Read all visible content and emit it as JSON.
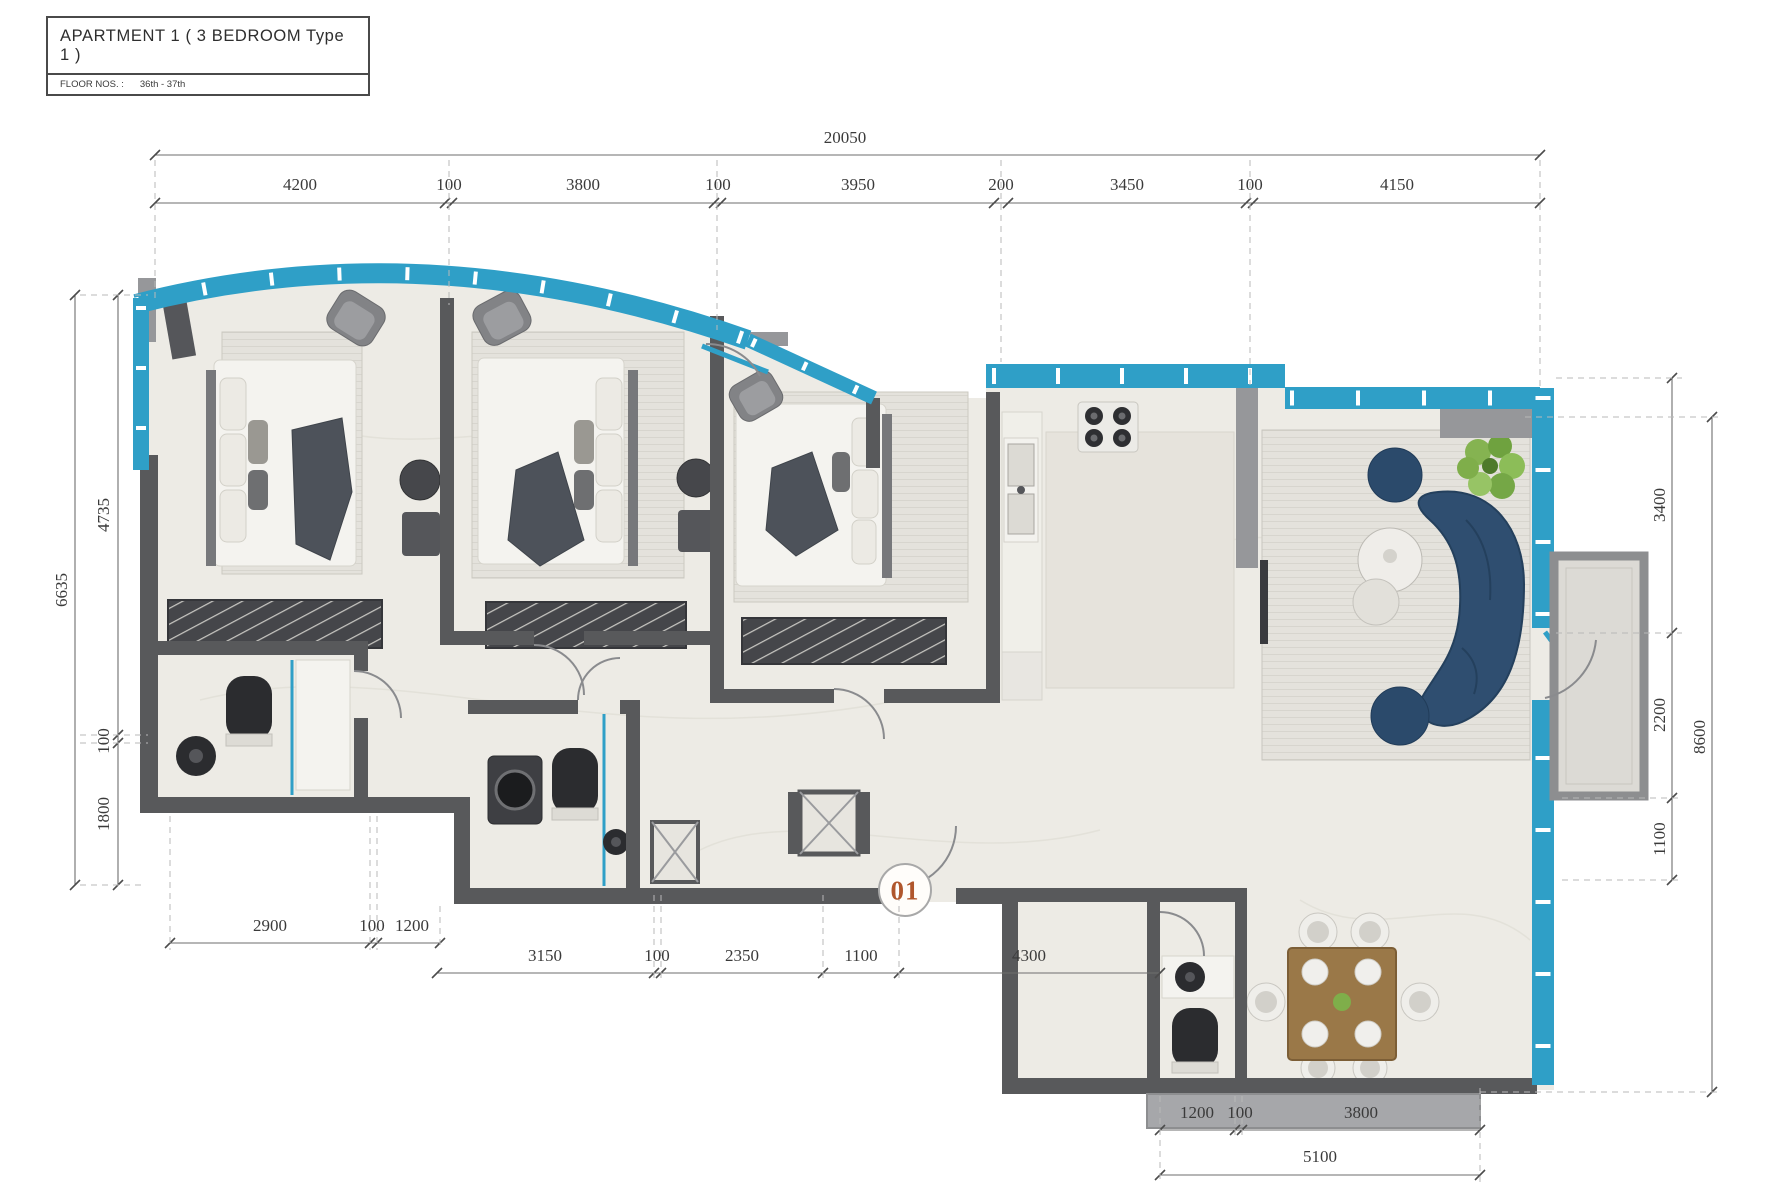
{
  "title_block": {
    "title": "APARTMENT  1  ( 3 BEDROOM Type  1 )",
    "floor_label": "FLOOR NOS. :",
    "floor_value": "36th - 37th"
  },
  "unit_marker": "01",
  "dimensions": {
    "top": {
      "total": "20050",
      "segments": [
        "4200",
        "100",
        "3800",
        "100",
        "3950",
        "200",
        "3450",
        "100",
        "4150"
      ]
    },
    "left": {
      "total": "6635",
      "segments": [
        "4735",
        "100",
        "1800"
      ]
    },
    "right": {
      "total": "8600",
      "segments": [
        "3400",
        "2200",
        "1100"
      ]
    },
    "bottom_left": {
      "segments": [
        "2900",
        "100",
        "1200"
      ]
    },
    "bottom_mid": {
      "segments": [
        "3150",
        "100",
        "2350",
        "1100",
        "4300"
      ]
    },
    "bottom_right": {
      "segments": [
        "1200",
        "100",
        "3800"
      ],
      "total": "5100"
    }
  },
  "colors": {
    "facade_teal": "#2f9fc7",
    "wall_gray": "#58595b",
    "wall_light": "#96979a",
    "floor": "#edebe5",
    "rug": "#e4e2dc",
    "sofa_navy": "#2f4e70",
    "pouf_navy": "#2b4a6b",
    "wood_brown": "#9a7848",
    "plant_green": "#7fae4a",
    "balcony_floor": "#dcdad5",
    "marker_orange": "#b0562c",
    "dim_line": "#6e6e6e",
    "text_dark": "#3c3c3c"
  }
}
